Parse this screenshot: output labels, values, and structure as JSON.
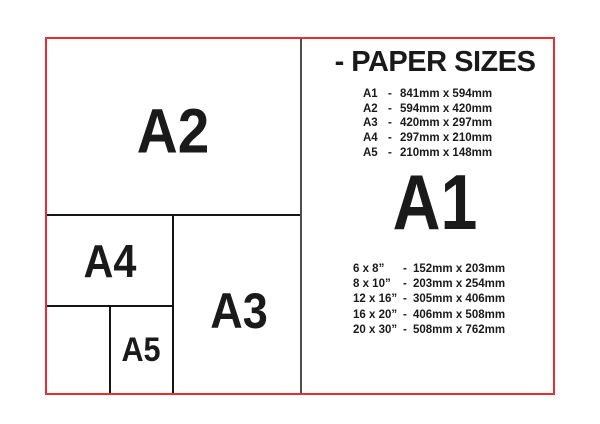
{
  "colors": {
    "frame_red": "#ee2b2e",
    "line_black": "#141414",
    "divider_gray": "#4d4d4d",
    "text_black": "#1a1a1a",
    "background": "#ffffff"
  },
  "diagram": {
    "a2_label": "A2",
    "a4_label": "A4",
    "a3_label": "A3",
    "a5_label": "A5"
  },
  "panel": {
    "title": "- PAPER SIZES",
    "featured_label": "A1",
    "a_sizes": [
      {
        "name": "A1",
        "dash": "-",
        "dims": "841mm x 594mm"
      },
      {
        "name": "A2",
        "dash": "-",
        "dims": "594mm x 420mm"
      },
      {
        "name": "A3",
        "dash": "-",
        "dims": "420mm x 297mm"
      },
      {
        "name": "A4",
        "dash": "-",
        "dims": "297mm x 210mm"
      },
      {
        "name": "A5",
        "dash": "-",
        "dims": "210mm x 148mm"
      }
    ],
    "inch_sizes": [
      {
        "name": "6 x 8”",
        "dash": "-",
        "dims": "152mm x 203mm"
      },
      {
        "name": "8 x 10”",
        "dash": "-",
        "dims": "203mm x 254mm"
      },
      {
        "name": "12 x 16”",
        "dash": "-",
        "dims": "305mm x 406mm"
      },
      {
        "name": "16 x 20”",
        "dash": "-",
        "dims": "406mm x 508mm"
      },
      {
        "name": "20 x 30”",
        "dash": "-",
        "dims": "508mm x 762mm"
      }
    ]
  }
}
